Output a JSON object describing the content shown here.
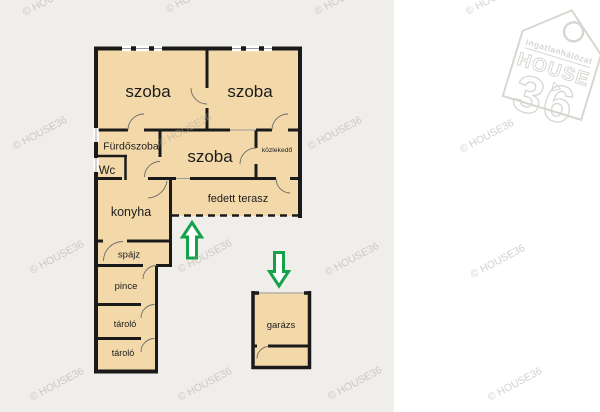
{
  "page": {
    "type": "real-estate floor plan image",
    "background_left": "#f0eeea",
    "background_right": "#ffffff"
  },
  "palette": {
    "room_fill": "#f3d9a9",
    "wall": "#1a1a1a",
    "window_line": "#9a9a9a",
    "door_arc": "#6b6b6b",
    "arrow_green": "#16a24b",
    "watermark_gray": "#a8a39c",
    "logo_gray": "#d9d6d2",
    "label_text": "#1c1c1c"
  },
  "floor_plan": {
    "rooms": [
      {
        "id": "szoba-1",
        "label": "szoba"
      },
      {
        "id": "szoba-2",
        "label": "szoba"
      },
      {
        "id": "szoba-3",
        "label": "szoba"
      },
      {
        "id": "furdoszoba",
        "label": "Fürdőszoba"
      },
      {
        "id": "wc",
        "label": "Wc"
      },
      {
        "id": "kozlekedo",
        "label": "közlekedő"
      },
      {
        "id": "fedett-terasz",
        "label": "fedett terasz"
      },
      {
        "id": "konyha",
        "label": "konyha"
      },
      {
        "id": "spajz",
        "label": "spájz"
      },
      {
        "id": "pince",
        "label": "pince"
      },
      {
        "id": "tarolo-1",
        "label": "tároló"
      },
      {
        "id": "tarolo-2",
        "label": "tároló"
      },
      {
        "id": "garazs",
        "label": "garázs"
      }
    ],
    "annotations": {
      "arrows": [
        {
          "icon": "arrow-up-icon",
          "direction": "up",
          "meaning": "entrance to house"
        },
        {
          "icon": "arrow-down-icon",
          "direction": "down",
          "meaning": "entrance to garage"
        }
      ]
    }
  },
  "watermark": {
    "text": "© HOUSE36"
  },
  "logo": {
    "network_label": "ingatlanhálózat",
    "brand": "HOUSE",
    "number": "36",
    "icon": "house-tag-logo-icon"
  }
}
